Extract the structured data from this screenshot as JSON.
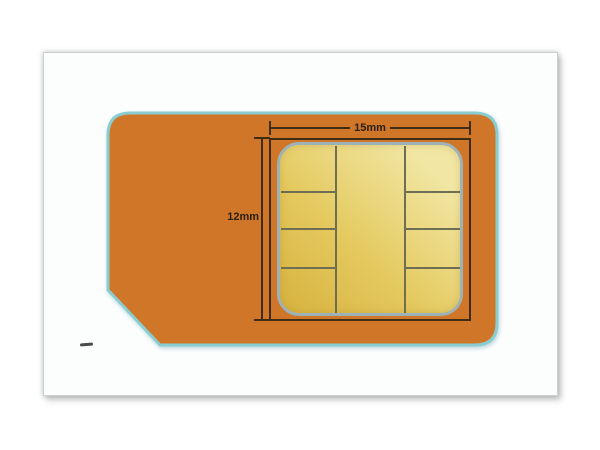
{
  "figure": {
    "name": "micro-sim-card-dimension-diagram",
    "labels": {
      "width": "15mm",
      "height": "12mm"
    },
    "chip": {
      "left_column_pads": 4,
      "center_column_pads": 1,
      "right_column_pads": 4
    },
    "stray_mark": "small dark dash on panel background"
  },
  "colors": {
    "page_bg": "#ffffff",
    "panel_bg": "#fcfefe",
    "panel_border": "#ccd0d0",
    "card_body": "#cf7629",
    "card_outline": "#8acdd1",
    "chip_gold_dark": "#d7b23f",
    "chip_gold_light": "#f1e6a3",
    "chip_border": "#9db2b6",
    "pad_divider": "#6e6e55",
    "dim_line": "#3e2d12",
    "label_color": "#2b2012",
    "stray_mark": "#4a4a48"
  }
}
